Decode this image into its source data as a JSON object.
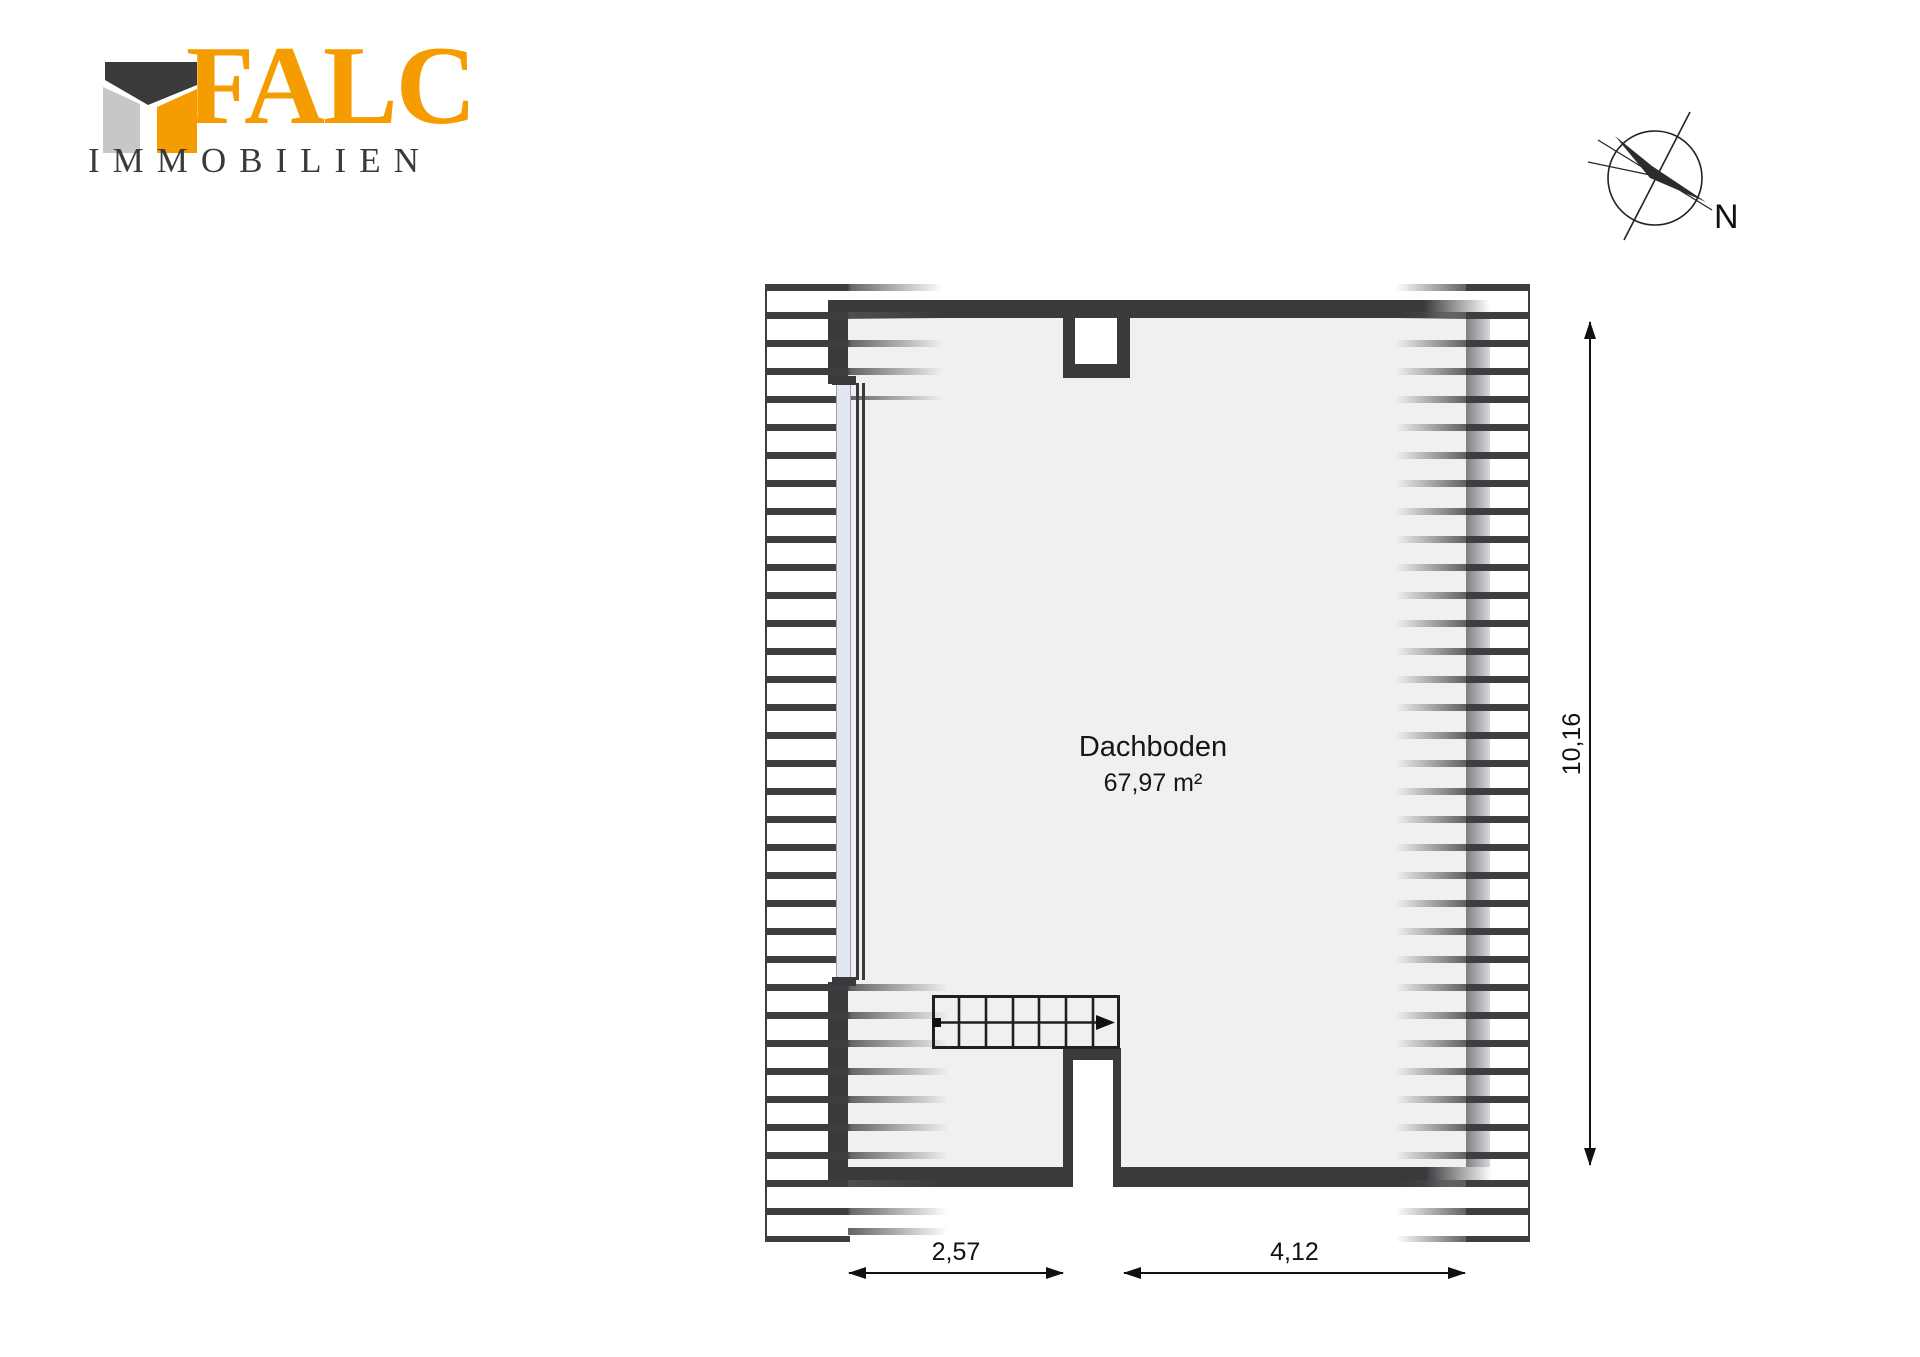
{
  "page": {
    "type": "floor-plan-sheet",
    "background": "#ffffff"
  },
  "branding": {
    "name": "FALC",
    "subtitle": "IMMOBILIEN",
    "colors": {
      "orange": "#f59c00",
      "dark": "#3a3a3d",
      "gray": "#c7c7c7"
    }
  },
  "compass": {
    "north_label": "N"
  },
  "floorplan": {
    "room": {
      "name": "Dachboden",
      "area": "67,97 m²"
    },
    "dimensions": {
      "bottom_left": "2,57",
      "bottom_right": "4,12",
      "right_height": "10,16"
    },
    "colors": {
      "wall": "#3a3a3d",
      "floor": "#f0f0f0",
      "window_glass": "#e1e8f2",
      "roof_hatch": "#3e3e41",
      "dimension_lines": "#111111"
    }
  }
}
